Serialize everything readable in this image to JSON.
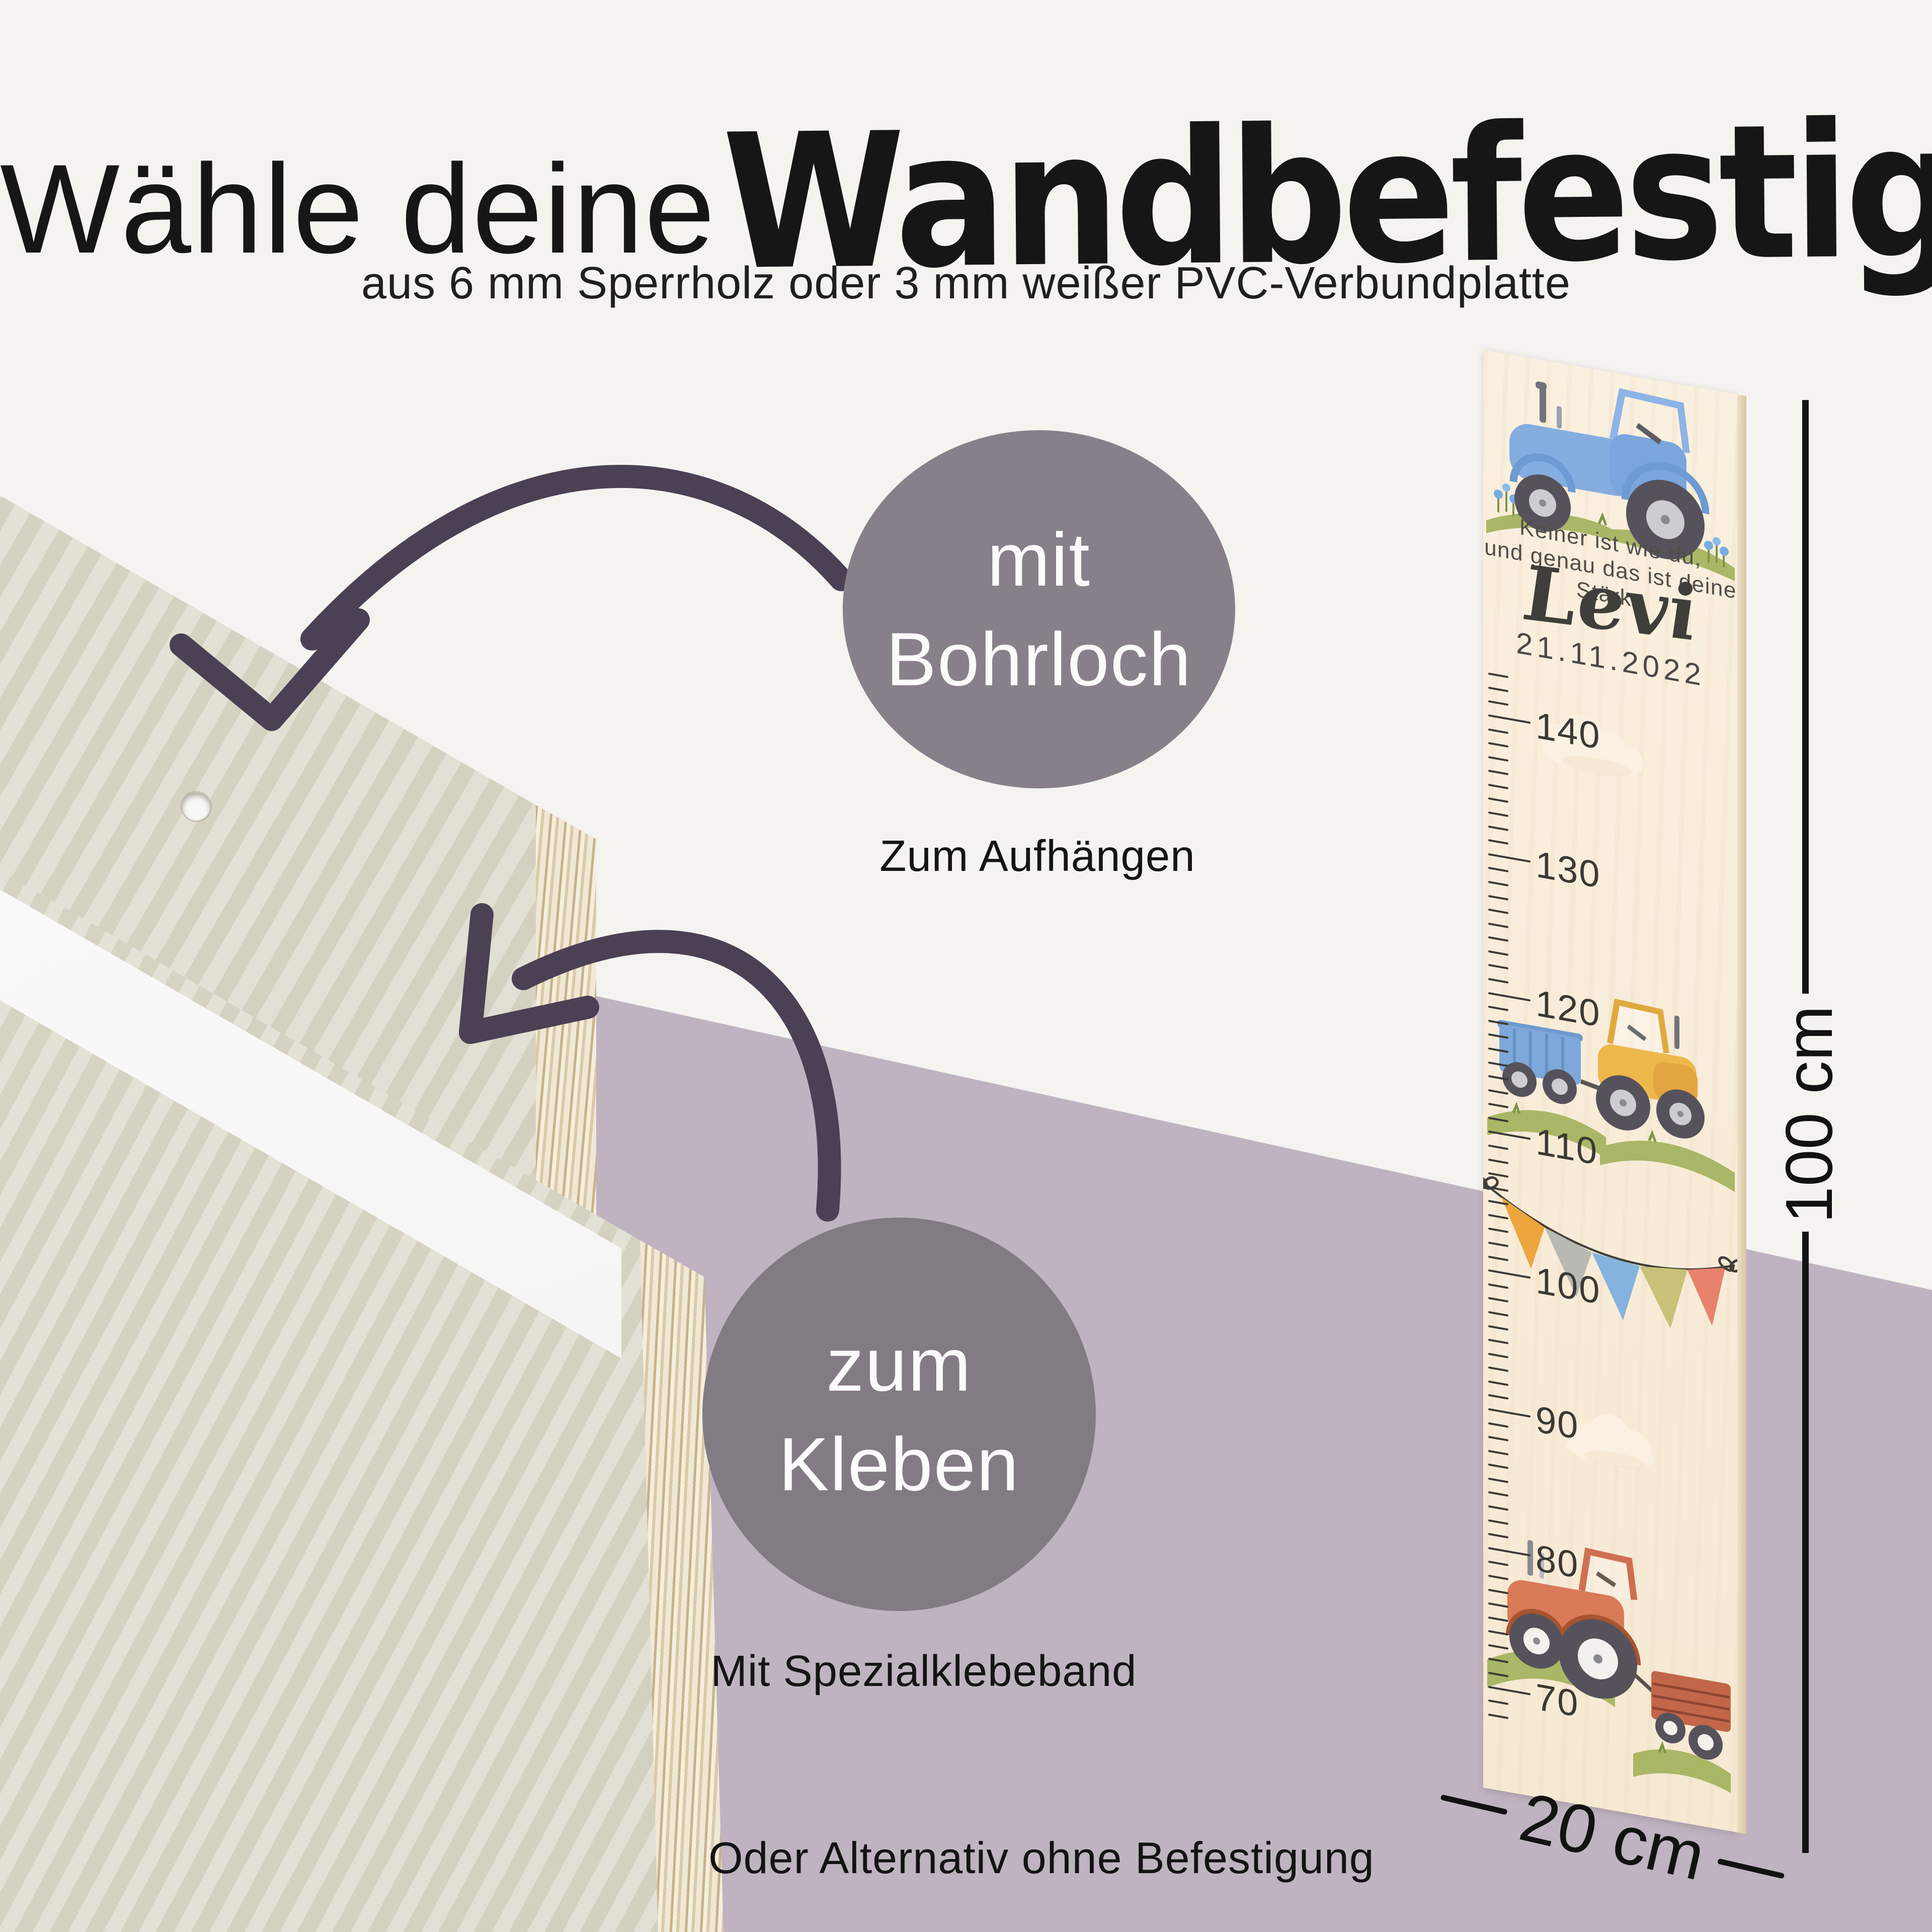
{
  "title": {
    "light": "Wähle deine",
    "marker": "Wandbefestigung"
  },
  "subtitle": "aus 6 mm Sperrholz oder 3 mm weißer PVC-Verbundplatte",
  "options": {
    "drill": {
      "circle_line1": "mit",
      "circle_line2": "Bohrloch",
      "caption": "Zum Aufhängen"
    },
    "glue": {
      "circle_line1": "zum",
      "circle_line2": "Kleben",
      "caption": "Mit Spezialklebeband"
    }
  },
  "footer": "Oder Alternativ ohne Befestigung",
  "growth_chart": {
    "quote_line1": "Keiner ist wie du,",
    "quote_line2": "und genau das ist deine Stärke",
    "name": "Levi",
    "date": "21.11.2022",
    "scale_numbers": [
      140,
      130,
      120,
      110,
      100,
      90,
      80,
      70
    ],
    "scale_minor_top": 143,
    "scale_minor_bottom": 68,
    "height_label": "100 cm",
    "width_label": "20 cm"
  },
  "colors": {
    "background_top": "#f4f3f0",
    "background_purple": "#bfb3c1",
    "circle_drill": "#87808a",
    "circle_glue": "#837b84",
    "arrow": "#4c4054",
    "chart_wood": "#f9efde",
    "bunting": [
      "#eca63d",
      "#b9b9b3",
      "#85b3e0",
      "#c9c178",
      "#e8826c"
    ],
    "tractor_blue": "#84ade0",
    "tractor_yellow": "#eeb74b",
    "tractor_red": "#d97a58",
    "grass": "#a9b766"
  }
}
